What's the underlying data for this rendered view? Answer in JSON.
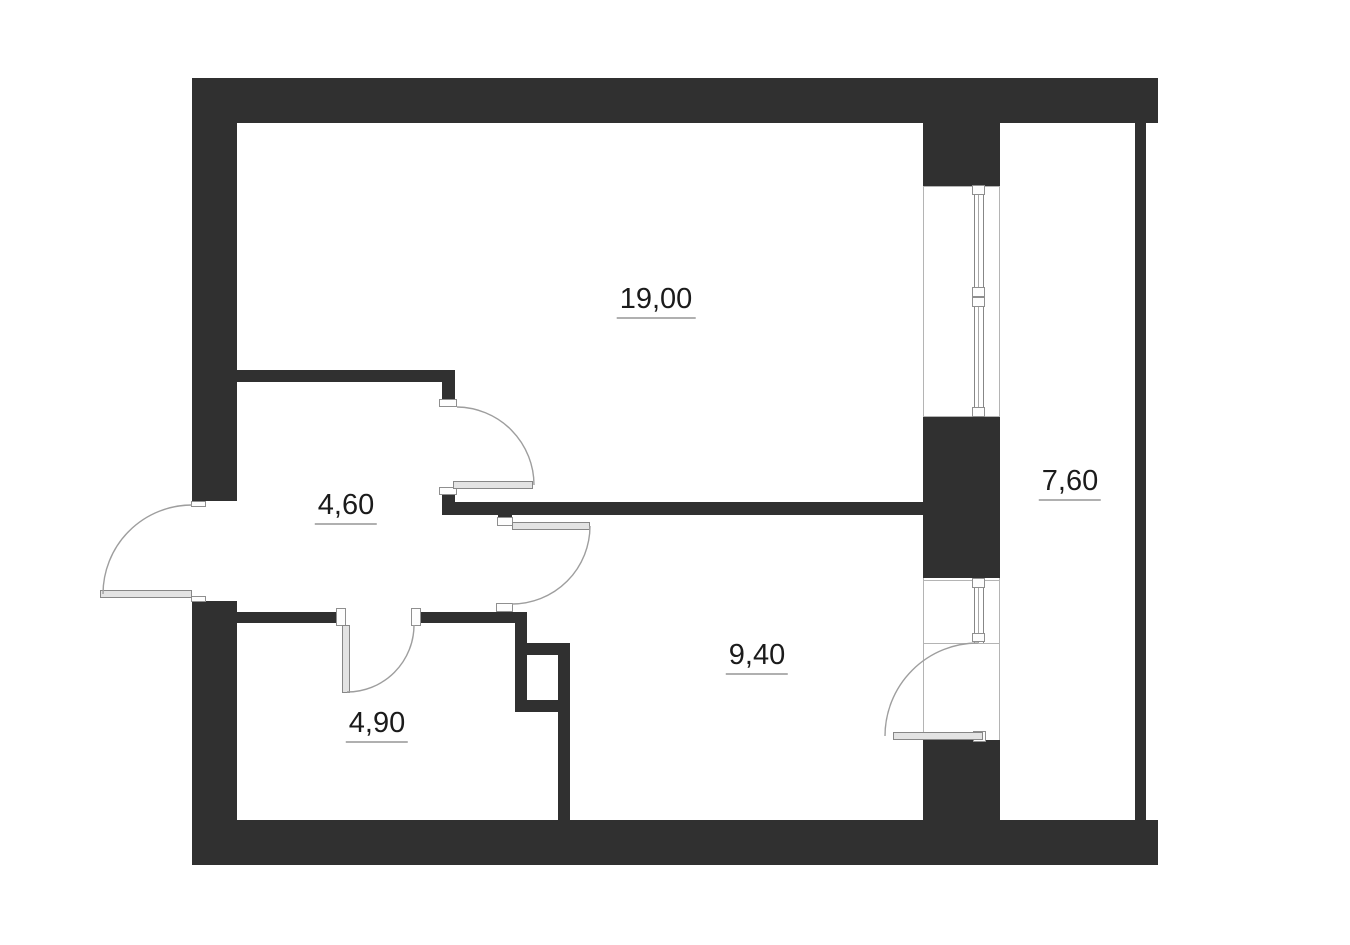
{
  "floorplan": {
    "rooms": [
      {
        "name": "living-room",
        "area_label": "19,00"
      },
      {
        "name": "hallway",
        "area_label": "4,60"
      },
      {
        "name": "bathroom",
        "area_label": "4,90"
      },
      {
        "name": "kitchen",
        "area_label": "9,40"
      },
      {
        "name": "balcony",
        "area_label": "7,60"
      }
    ],
    "colors": {
      "wall": "#303030",
      "line": "#9e9e9e",
      "bay_line": "#b4b4b4",
      "leaf_fill": "#e3e3e3",
      "leaf_border": "#878787",
      "cap_fill": "#fdfdfd",
      "label_text": "#1b1b1b",
      "label_underline": "#b0b0b0",
      "background": "#ffffff"
    }
  }
}
